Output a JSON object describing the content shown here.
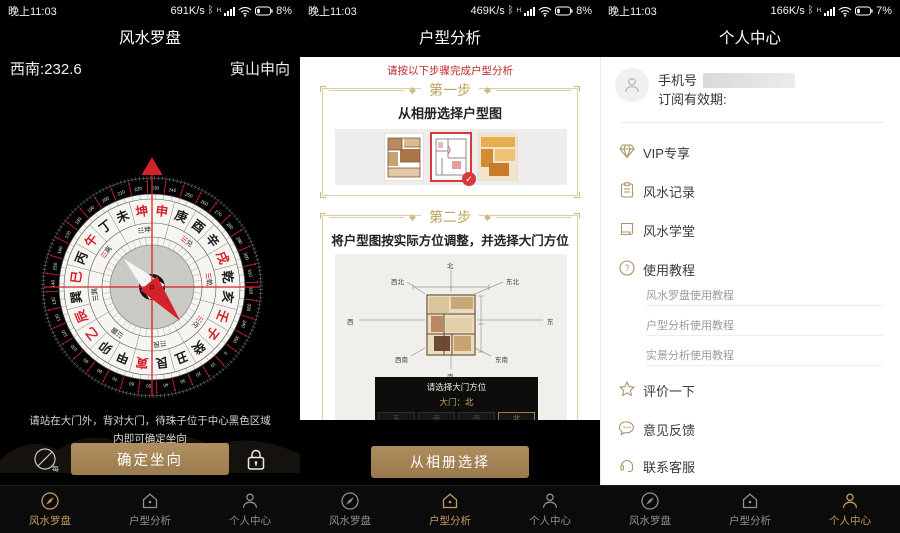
{
  "tabs": [
    {
      "label": "风水罗盘"
    },
    {
      "label": "户型分析"
    },
    {
      "label": "个人中心"
    }
  ],
  "compass_panel": {
    "status": {
      "time": "晚上11:03",
      "speed": "691K/s",
      "battery": "8%"
    },
    "title": "风水罗盘",
    "direction_reading": "西南:232.6",
    "orientation": "寅山申向",
    "instructions_line1": "请站在大门外，背对大门，待珠子位于中心黑色区域",
    "instructions_line2": "内即可确定坐向",
    "confirm_button": "确定坐向",
    "calibrate_hint": "每",
    "compass": {
      "heading_degrees": 232.6,
      "degree_step": 10,
      "degree_max": 350,
      "mountains": [
        "子",
        "癸",
        "丑",
        "艮",
        "寅",
        "甲",
        "卯",
        "乙",
        "辰",
        "巽",
        "巳",
        "丙",
        "午",
        "丁",
        "未",
        "坤",
        "申",
        "庚",
        "酉",
        "辛",
        "戌",
        "乾",
        "亥",
        "壬"
      ],
      "red_mountains": [
        "坤",
        "申",
        "午",
        "乙",
        "辰",
        "寅",
        "戌",
        "壬",
        "子",
        "巳"
      ],
      "trigrams": [
        {
          "name": "坎",
          "glyph": "☵",
          "bearing": 0,
          "red": true
        },
        {
          "name": "艮",
          "glyph": "☶",
          "bearing": 45,
          "red": false
        },
        {
          "name": "震",
          "glyph": "☳",
          "bearing": 90,
          "red": false
        },
        {
          "name": "巽",
          "glyph": "☴",
          "bearing": 135,
          "red": false
        },
        {
          "name": "离",
          "glyph": "☲",
          "bearing": 180,
          "red": true
        },
        {
          "name": "坤",
          "glyph": "☷",
          "bearing": 225,
          "red": false
        },
        {
          "name": "兑",
          "glyph": "☱",
          "bearing": 270,
          "red": true
        },
        {
          "name": "乾",
          "glyph": "☰",
          "bearing": 315,
          "red": true
        }
      ]
    }
  },
  "analysis_panel": {
    "status": {
      "time": "晚上11:03",
      "speed": "469K/s",
      "battery": "8%"
    },
    "title": "户型分析",
    "intro": "请按以下步骤完成户型分析",
    "step1": {
      "header": "第一步",
      "instruction": "从相册选择户型图",
      "selected_thumbnail_index": 1
    },
    "step2": {
      "header": "第二步",
      "instruction": "将户型图按实际方位调整，并选择大门方位",
      "directions": {
        "n": "北",
        "ne": "东北",
        "e": "东",
        "se": "东南",
        "s": "南",
        "sw": "西南",
        "w": "西",
        "nw": "西北"
      }
    },
    "door_dialog": {
      "title": "请选择大门方位",
      "door_label": "大门：",
      "door_value": "北",
      "options": [
        "东",
        "南",
        "西",
        "北"
      ],
      "selected_index": 3
    },
    "album_button": "从相册选择"
  },
  "profile_panel": {
    "status": {
      "time": "晚上11:03",
      "speed": "166K/s",
      "battery": "7%"
    },
    "title": "个人中心",
    "phone_label": "手机号",
    "subscription_label": "订阅有效期:",
    "menu": [
      {
        "icon": "diamond-icon",
        "label": "VIP专享"
      },
      {
        "icon": "clipboard-icon",
        "label": "风水记录"
      },
      {
        "icon": "book-icon",
        "label": "风水学堂"
      },
      {
        "icon": "question-icon",
        "label": "使用教程"
      }
    ],
    "tutorials": [
      "风水罗盘使用教程",
      "户型分析使用教程",
      "实景分析使用教程"
    ],
    "menu_extra": [
      {
        "icon": "star-icon",
        "label": "评价一下"
      },
      {
        "icon": "chat-icon",
        "label": "意见反馈"
      },
      {
        "icon": "headset-icon",
        "label": "联系客服"
      }
    ]
  }
}
